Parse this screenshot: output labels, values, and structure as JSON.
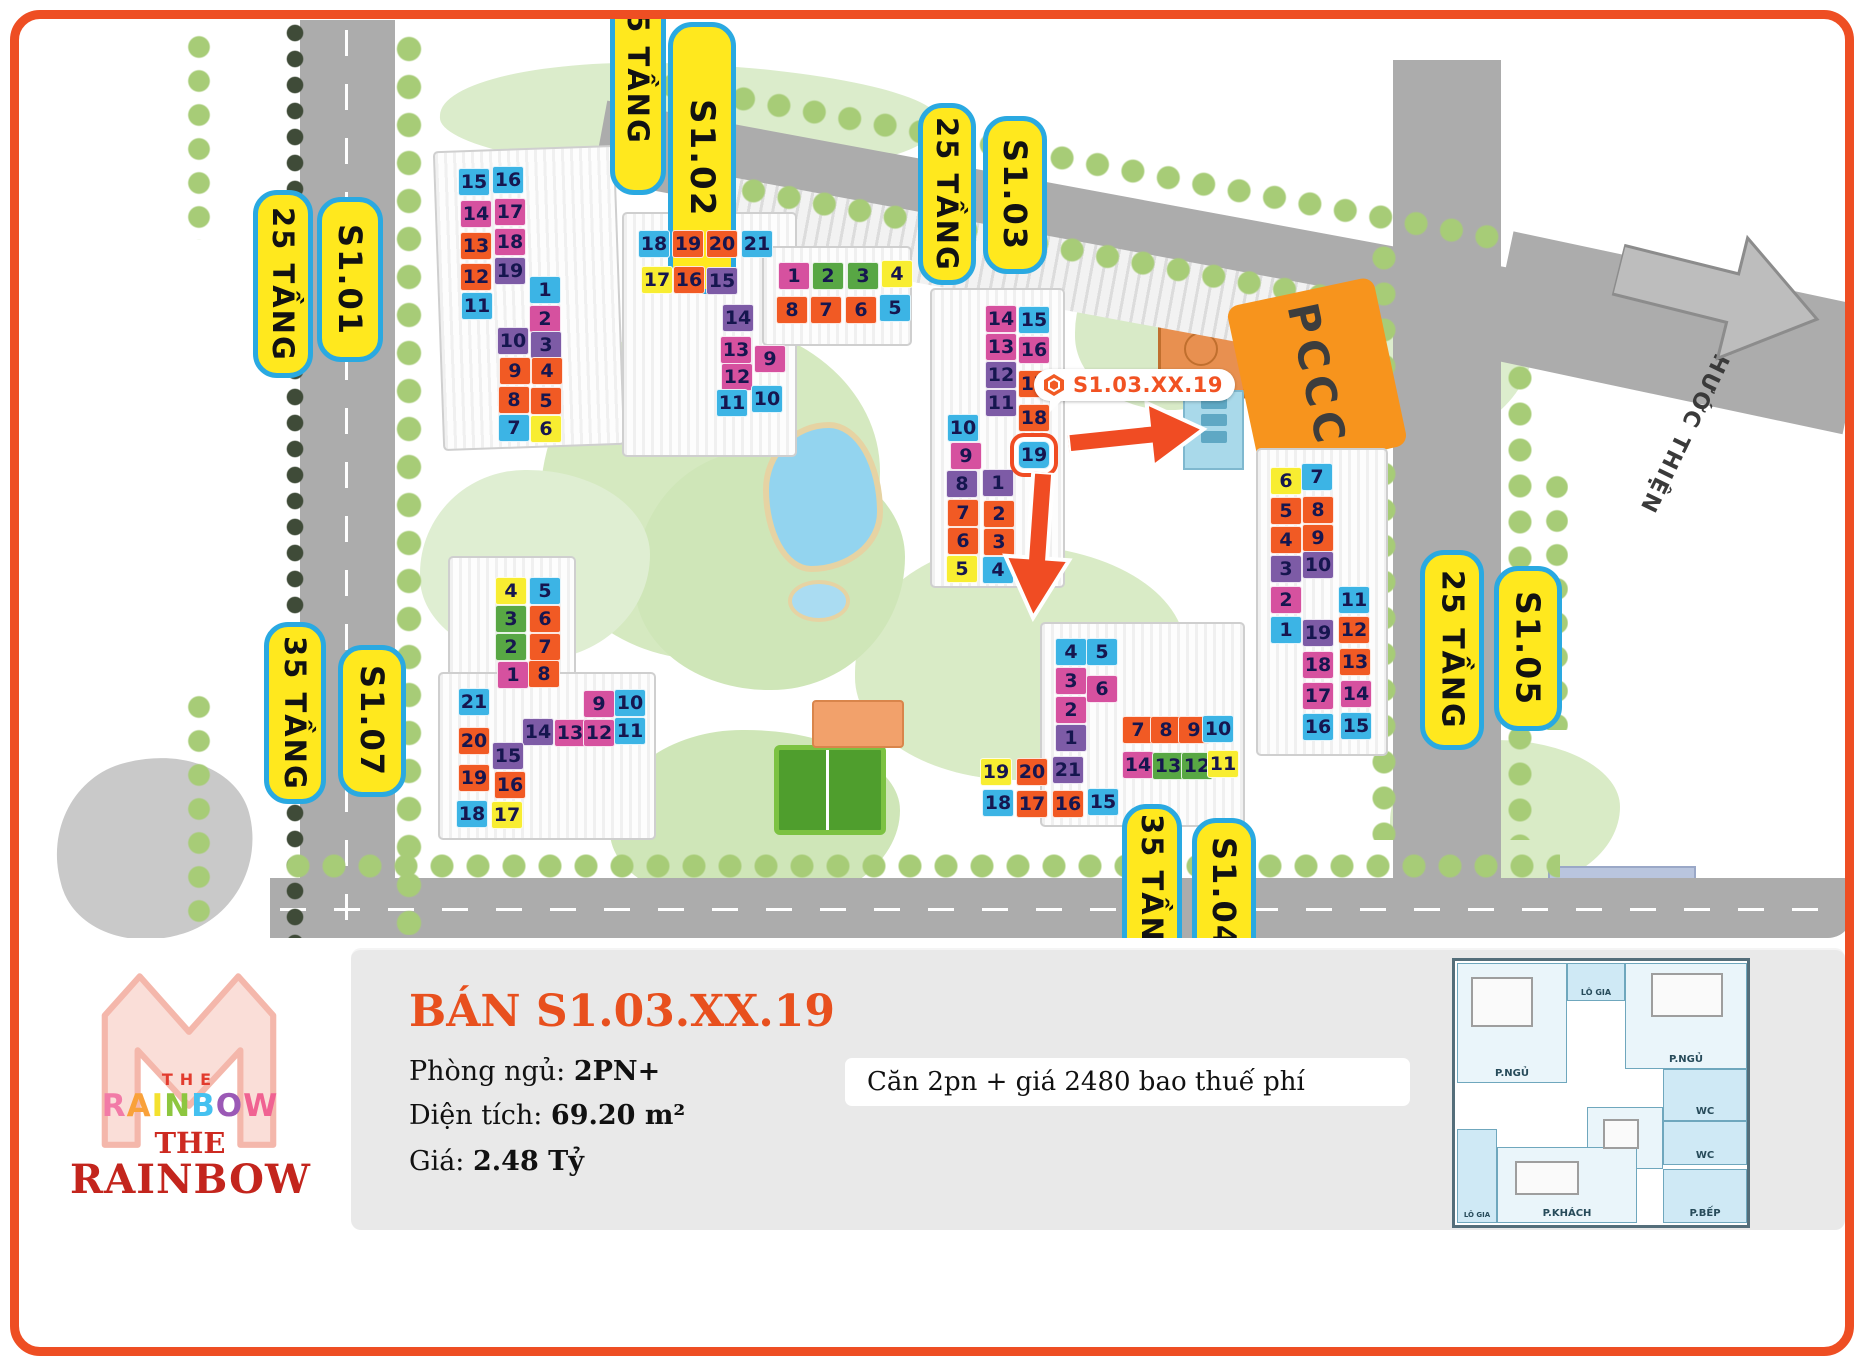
{
  "map": {
    "palette": {
      "blue": "#3cb4e5",
      "pink": "#d6519f",
      "orange": "#f15a24",
      "purple": "#7d5ba6",
      "yellow": "#f8ed31",
      "green": "#58a744"
    },
    "street_arrow_label": "ĐI Đ. PHƯỚC THIỆN",
    "pccc_label": "PCCC",
    "marker": {
      "label": "S1.03.XX.19"
    },
    "building_labels": [
      {
        "id": "tang25-left",
        "text": "25 TẦNG",
        "x": 253,
        "y": 190,
        "w": 60,
        "h": 188,
        "fs": 29
      },
      {
        "id": "s101",
        "text": "S1.01",
        "x": 317,
        "y": 197,
        "w": 66,
        "h": 165,
        "fs": 32
      },
      {
        "id": "tang25-top",
        "text": "25 TẦNG",
        "x": 610,
        "y": -60,
        "w": 56,
        "h": 255,
        "fs": 29
      },
      {
        "id": "s102",
        "text": "S1.02",
        "x": 668,
        "y": 22,
        "w": 68,
        "h": 272,
        "fs": 34
      },
      {
        "id": "tang25-mid",
        "text": "25 TẦNG",
        "x": 918,
        "y": 103,
        "w": 58,
        "h": 182,
        "fs": 29
      },
      {
        "id": "s103",
        "text": "S1.03",
        "x": 983,
        "y": 116,
        "w": 64,
        "h": 158,
        "fs": 32
      },
      {
        "id": "tang25-right",
        "text": "25 TẦNG",
        "x": 1420,
        "y": 550,
        "w": 64,
        "h": 200,
        "fs": 30
      },
      {
        "id": "s105",
        "text": "S1.05",
        "x": 1494,
        "y": 566,
        "w": 68,
        "h": 165,
        "fs": 33
      },
      {
        "id": "tang35-left",
        "text": "35 TẦNG",
        "x": 264,
        "y": 622,
        "w": 62,
        "h": 182,
        "fs": 29
      },
      {
        "id": "s107",
        "text": "S1.07",
        "x": 338,
        "y": 645,
        "w": 68,
        "h": 152,
        "fs": 32
      },
      {
        "id": "tang35-bottom",
        "text": "35 TẦNG",
        "x": 1122,
        "y": 804,
        "w": 60,
        "h": 175,
        "fs": 29
      },
      {
        "id": "s104",
        "text": "S1.04",
        "x": 1192,
        "y": 818,
        "w": 64,
        "h": 150,
        "fs": 32
      }
    ],
    "units": [
      {
        "b": "S1.01",
        "n": "15",
        "k": "blue",
        "x": 458,
        "y": 168
      },
      {
        "b": "S1.01",
        "n": "16",
        "k": "blue",
        "x": 492,
        "y": 166
      },
      {
        "b": "S1.01",
        "n": "14",
        "k": "pink",
        "x": 460,
        "y": 200
      },
      {
        "b": "S1.01",
        "n": "17",
        "k": "pink",
        "x": 494,
        "y": 198
      },
      {
        "b": "S1.01",
        "n": "13",
        "k": "orange",
        "x": 460,
        "y": 232
      },
      {
        "b": "S1.01",
        "n": "18",
        "k": "pink",
        "x": 494,
        "y": 228
      },
      {
        "b": "S1.01",
        "n": "12",
        "k": "orange",
        "x": 460,
        "y": 263
      },
      {
        "b": "S1.01",
        "n": "19",
        "k": "purple",
        "x": 494,
        "y": 257
      },
      {
        "b": "S1.01",
        "n": "11",
        "k": "blue",
        "x": 461,
        "y": 292
      },
      {
        "b": "S1.01",
        "n": "1",
        "k": "blue",
        "x": 529,
        "y": 276
      },
      {
        "b": "S1.01",
        "n": "2",
        "k": "pink",
        "x": 529,
        "y": 305
      },
      {
        "b": "S1.01",
        "n": "10",
        "k": "purple",
        "x": 497,
        "y": 327
      },
      {
        "b": "S1.01",
        "n": "3",
        "k": "purple",
        "x": 530,
        "y": 331
      },
      {
        "b": "S1.01",
        "n": "9",
        "k": "orange",
        "x": 499,
        "y": 357
      },
      {
        "b": "S1.01",
        "n": "4",
        "k": "orange",
        "x": 531,
        "y": 357
      },
      {
        "b": "S1.01",
        "n": "8",
        "k": "orange",
        "x": 498,
        "y": 386
      },
      {
        "b": "S1.01",
        "n": "5",
        "k": "orange",
        "x": 530,
        "y": 387
      },
      {
        "b": "S1.01",
        "n": "7",
        "k": "blue",
        "x": 498,
        "y": 414
      },
      {
        "b": "S1.01",
        "n": "6",
        "k": "yellow",
        "x": 530,
        "y": 415
      },
      {
        "b": "S1.02",
        "n": "18",
        "k": "blue",
        "x": 638,
        "y": 230
      },
      {
        "b": "S1.02",
        "n": "19",
        "k": "orange",
        "x": 672,
        "y": 230
      },
      {
        "b": "S1.02",
        "n": "20",
        "k": "orange",
        "x": 706,
        "y": 230
      },
      {
        "b": "S1.02",
        "n": "21",
        "k": "blue",
        "x": 741,
        "y": 230
      },
      {
        "b": "S1.02",
        "n": "17",
        "k": "yellow",
        "x": 641,
        "y": 266
      },
      {
        "b": "S1.02",
        "n": "16",
        "k": "orange",
        "x": 673,
        "y": 266
      },
      {
        "b": "S1.02",
        "n": "15",
        "k": "purple",
        "x": 706,
        "y": 267
      },
      {
        "b": "S1.02",
        "n": "14",
        "k": "purple",
        "x": 722,
        "y": 304
      },
      {
        "b": "S1.02",
        "n": "13",
        "k": "pink",
        "x": 720,
        "y": 336
      },
      {
        "b": "S1.02",
        "n": "9",
        "k": "pink",
        "x": 754,
        "y": 345
      },
      {
        "b": "S1.02",
        "n": "12",
        "k": "pink",
        "x": 721,
        "y": 363
      },
      {
        "b": "S1.02",
        "n": "11",
        "k": "blue",
        "x": 716,
        "y": 389
      },
      {
        "b": "S1.02",
        "n": "10",
        "k": "blue",
        "x": 751,
        "y": 385
      },
      {
        "b": "S1.02B",
        "n": "1",
        "k": "pink",
        "x": 778,
        "y": 262
      },
      {
        "b": "S1.02B",
        "n": "2",
        "k": "green",
        "x": 812,
        "y": 262
      },
      {
        "b": "S1.02B",
        "n": "3",
        "k": "green",
        "x": 847,
        "y": 262
      },
      {
        "b": "S1.02B",
        "n": "4",
        "k": "yellow",
        "x": 881,
        "y": 260
      },
      {
        "b": "S1.02B",
        "n": "8",
        "k": "orange",
        "x": 776,
        "y": 296
      },
      {
        "b": "S1.02B",
        "n": "7",
        "k": "orange",
        "x": 810,
        "y": 296
      },
      {
        "b": "S1.02B",
        "n": "6",
        "k": "orange",
        "x": 845,
        "y": 296
      },
      {
        "b": "S1.02B",
        "n": "5",
        "k": "blue",
        "x": 879,
        "y": 294
      },
      {
        "b": "S1.03",
        "n": "14",
        "k": "pink",
        "x": 985,
        "y": 305
      },
      {
        "b": "S1.03",
        "n": "15",
        "k": "blue",
        "x": 1018,
        "y": 306
      },
      {
        "b": "S1.03",
        "n": "13",
        "k": "pink",
        "x": 985,
        "y": 333
      },
      {
        "b": "S1.03",
        "n": "16",
        "k": "pink",
        "x": 1018,
        "y": 336
      },
      {
        "b": "S1.03",
        "n": "12",
        "k": "purple",
        "x": 985,
        "y": 361
      },
      {
        "b": "S1.03",
        "n": "17",
        "k": "orange",
        "x": 1018,
        "y": 370
      },
      {
        "b": "S1.03",
        "n": "11",
        "k": "purple",
        "x": 985,
        "y": 389
      },
      {
        "b": "S1.03",
        "n": "18",
        "k": "orange",
        "x": 1018,
        "y": 404
      },
      {
        "b": "S1.03",
        "n": "19",
        "k": "blue",
        "x": 1018,
        "y": 441,
        "hl": true
      },
      {
        "b": "S1.03",
        "n": "10",
        "k": "blue",
        "x": 947,
        "y": 414
      },
      {
        "b": "S1.03",
        "n": "9",
        "k": "pink",
        "x": 950,
        "y": 442
      },
      {
        "b": "S1.03",
        "n": "8",
        "k": "purple",
        "x": 946,
        "y": 470
      },
      {
        "b": "S1.03",
        "n": "1",
        "k": "purple",
        "x": 982,
        "y": 469
      },
      {
        "b": "S1.03",
        "n": "7",
        "k": "orange",
        "x": 947,
        "y": 499
      },
      {
        "b": "S1.03",
        "n": "2",
        "k": "orange",
        "x": 983,
        "y": 500
      },
      {
        "b": "S1.03",
        "n": "6",
        "k": "orange",
        "x": 947,
        "y": 527
      },
      {
        "b": "S1.03",
        "n": "3",
        "k": "orange",
        "x": 983,
        "y": 528
      },
      {
        "b": "S1.03",
        "n": "5",
        "k": "yellow",
        "x": 946,
        "y": 555
      },
      {
        "b": "S1.03",
        "n": "4",
        "k": "blue",
        "x": 982,
        "y": 556
      },
      {
        "b": "S1.05",
        "n": "6",
        "k": "yellow",
        "x": 1270,
        "y": 467
      },
      {
        "b": "S1.05",
        "n": "7",
        "k": "blue",
        "x": 1301,
        "y": 463
      },
      {
        "b": "S1.05",
        "n": "5",
        "k": "orange",
        "x": 1270,
        "y": 497
      },
      {
        "b": "S1.05",
        "n": "8",
        "k": "orange",
        "x": 1302,
        "y": 496
      },
      {
        "b": "S1.05",
        "n": "4",
        "k": "orange",
        "x": 1270,
        "y": 526
      },
      {
        "b": "S1.05",
        "n": "9",
        "k": "orange",
        "x": 1302,
        "y": 524
      },
      {
        "b": "S1.05",
        "n": "3",
        "k": "purple",
        "x": 1270,
        "y": 555
      },
      {
        "b": "S1.05",
        "n": "10",
        "k": "purple",
        "x": 1302,
        "y": 551
      },
      {
        "b": "S1.05",
        "n": "2",
        "k": "pink",
        "x": 1270,
        "y": 586
      },
      {
        "b": "S1.05",
        "n": "11",
        "k": "blue",
        "x": 1338,
        "y": 586
      },
      {
        "b": "S1.05",
        "n": "1",
        "k": "blue",
        "x": 1270,
        "y": 616
      },
      {
        "b": "S1.05",
        "n": "19",
        "k": "purple",
        "x": 1302,
        "y": 619
      },
      {
        "b": "S1.05",
        "n": "12",
        "k": "orange",
        "x": 1338,
        "y": 616
      },
      {
        "b": "S1.05",
        "n": "18",
        "k": "pink",
        "x": 1302,
        "y": 651
      },
      {
        "b": "S1.05",
        "n": "13",
        "k": "orange",
        "x": 1339,
        "y": 648
      },
      {
        "b": "S1.05",
        "n": "17",
        "k": "pink",
        "x": 1302,
        "y": 682
      },
      {
        "b": "S1.05",
        "n": "14",
        "k": "pink",
        "x": 1340,
        "y": 680
      },
      {
        "b": "S1.05",
        "n": "16",
        "k": "blue",
        "x": 1302,
        "y": 713
      },
      {
        "b": "S1.05",
        "n": "15",
        "k": "blue",
        "x": 1340,
        "y": 712
      },
      {
        "b": "S1.07",
        "n": "4",
        "k": "yellow",
        "x": 495,
        "y": 577
      },
      {
        "b": "S1.07",
        "n": "5",
        "k": "blue",
        "x": 529,
        "y": 577
      },
      {
        "b": "S1.07",
        "n": "3",
        "k": "green",
        "x": 495,
        "y": 605
      },
      {
        "b": "S1.07",
        "n": "6",
        "k": "orange",
        "x": 529,
        "y": 605
      },
      {
        "b": "S1.07",
        "n": "2",
        "k": "green",
        "x": 495,
        "y": 633
      },
      {
        "b": "S1.07",
        "n": "7",
        "k": "orange",
        "x": 529,
        "y": 633
      },
      {
        "b": "S1.07",
        "n": "1",
        "k": "pink",
        "x": 497,
        "y": 661
      },
      {
        "b": "S1.07",
        "n": "8",
        "k": "orange",
        "x": 528,
        "y": 660
      },
      {
        "b": "S1.07",
        "n": "21",
        "k": "blue",
        "x": 458,
        "y": 688
      },
      {
        "b": "S1.07",
        "n": "9",
        "k": "pink",
        "x": 583,
        "y": 690
      },
      {
        "b": "S1.07",
        "n": "10",
        "k": "blue",
        "x": 614,
        "y": 689
      },
      {
        "b": "S1.07",
        "n": "20",
        "k": "orange",
        "x": 458,
        "y": 727
      },
      {
        "b": "S1.07",
        "n": "14",
        "k": "purple",
        "x": 522,
        "y": 718
      },
      {
        "b": "S1.07",
        "n": "13",
        "k": "pink",
        "x": 554,
        "y": 719
      },
      {
        "b": "S1.07",
        "n": "12",
        "k": "pink",
        "x": 583,
        "y": 719
      },
      {
        "b": "S1.07",
        "n": "11",
        "k": "blue",
        "x": 614,
        "y": 717
      },
      {
        "b": "S1.07",
        "n": "19",
        "k": "orange",
        "x": 458,
        "y": 764
      },
      {
        "b": "S1.07",
        "n": "15",
        "k": "purple",
        "x": 492,
        "y": 742
      },
      {
        "b": "S1.07",
        "n": "18",
        "k": "blue",
        "x": 456,
        "y": 800
      },
      {
        "b": "S1.07",
        "n": "16",
        "k": "orange",
        "x": 494,
        "y": 771
      },
      {
        "b": "S1.07",
        "n": "17",
        "k": "yellow",
        "x": 491,
        "y": 801
      },
      {
        "b": "S1.04",
        "n": "4",
        "k": "blue",
        "x": 1055,
        "y": 638
      },
      {
        "b": "S1.04",
        "n": "5",
        "k": "blue",
        "x": 1086,
        "y": 638
      },
      {
        "b": "S1.04",
        "n": "3",
        "k": "pink",
        "x": 1055,
        "y": 667
      },
      {
        "b": "S1.04",
        "n": "6",
        "k": "pink",
        "x": 1086,
        "y": 675
      },
      {
        "b": "S1.04",
        "n": "2",
        "k": "pink",
        "x": 1055,
        "y": 696
      },
      {
        "b": "S1.04",
        "n": "1",
        "k": "purple",
        "x": 1055,
        "y": 724
      },
      {
        "b": "S1.04",
        "n": "7",
        "k": "orange",
        "x": 1122,
        "y": 716
      },
      {
        "b": "S1.04",
        "n": "8",
        "k": "orange",
        "x": 1150,
        "y": 716
      },
      {
        "b": "S1.04",
        "n": "9",
        "k": "orange",
        "x": 1178,
        "y": 716
      },
      {
        "b": "S1.04",
        "n": "10",
        "k": "blue",
        "x": 1202,
        "y": 715
      },
      {
        "b": "S1.04",
        "n": "14",
        "k": "pink",
        "x": 1122,
        "y": 751
      },
      {
        "b": "S1.04",
        "n": "13",
        "k": "green",
        "x": 1152,
        "y": 752
      },
      {
        "b": "S1.04",
        "n": "12",
        "k": "green",
        "x": 1181,
        "y": 752
      },
      {
        "b": "S1.04",
        "n": "11",
        "k": "yellow",
        "x": 1207,
        "y": 750
      },
      {
        "b": "S1.04",
        "n": "19",
        "k": "yellow",
        "x": 980,
        "y": 758
      },
      {
        "b": "S1.04",
        "n": "20",
        "k": "orange",
        "x": 1016,
        "y": 758
      },
      {
        "b": "S1.04",
        "n": "21",
        "k": "purple",
        "x": 1052,
        "y": 756
      },
      {
        "b": "S1.04",
        "n": "18",
        "k": "blue",
        "x": 982,
        "y": 789
      },
      {
        "b": "S1.04",
        "n": "17",
        "k": "orange",
        "x": 1016,
        "y": 790
      },
      {
        "b": "S1.04",
        "n": "16",
        "k": "orange",
        "x": 1052,
        "y": 790
      },
      {
        "b": "S1.04",
        "n": "15",
        "k": "blue",
        "x": 1087,
        "y": 788
      }
    ]
  },
  "info_panel": {
    "title": "BÁN S1.03.XX.19",
    "fields": [
      {
        "label": "Phòng ngủ: ",
        "value": "2PN+"
      },
      {
        "label": "Diện tích: ",
        "value": "69.20 m²"
      },
      {
        "label": "Giá: ",
        "value": "2.48 Tỷ"
      }
    ],
    "note": "Căn 2pn + giá 2480 bao thuế phí"
  },
  "logo": {
    "the": "THE",
    "rainbow": "RAINBOW",
    "rainbow_colors": [
      "#f27ba7",
      "#f9a13a",
      "#f4e12f",
      "#8dc63f",
      "#45c1f0",
      "#9b59b6",
      "#f06292"
    ],
    "the2": "THE",
    "rainbow2": "RAINBOW"
  },
  "floor_plan": {
    "rooms": [
      "P.NGỦ",
      "LÔ GIA",
      "P.NGỦ",
      "WC",
      "WC",
      "P.ĂN",
      "LÔ GIA",
      "P.KHÁCH",
      "P.BẾP"
    ]
  }
}
